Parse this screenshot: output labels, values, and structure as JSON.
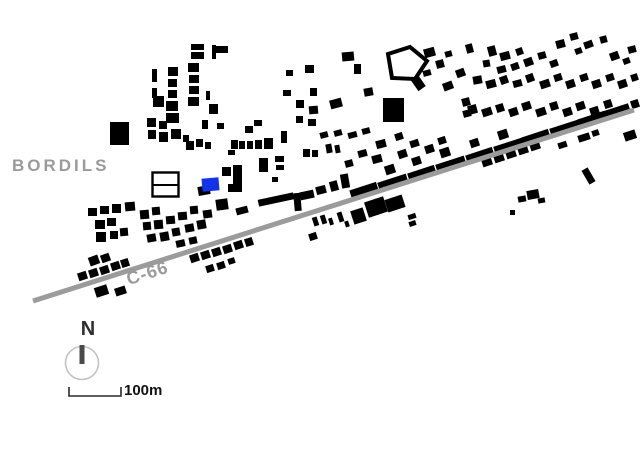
{
  "map": {
    "town_label": "BORDILS",
    "road_label": "C-66",
    "colors": {
      "building": "#000000",
      "highlight": "#1333e8",
      "road": "#9b9b9b",
      "label_gray": "#9a9a9a",
      "outline_stroke": "#000000",
      "background": "#ffffff"
    },
    "road": {
      "x1": 33,
      "y1": 301,
      "x2": 634,
      "y2": 110,
      "width": 5
    },
    "highlight_building": [
      202,
      178,
      17,
      13,
      -5
    ],
    "outline_rect_building": {
      "x": 152.5,
      "y": 172.5,
      "w": 26,
      "h": 24,
      "divider_y": 185,
      "stroke_width": 2.4
    },
    "pentagon_building": {
      "points": [
        [
          388,
          54
        ],
        [
          410,
          47
        ],
        [
          427,
          61
        ],
        [
          415,
          79
        ],
        [
          392,
          78
        ]
      ],
      "stroke_width": 4,
      "tail": [
        413,
        74,
        9,
        16,
        -35
      ]
    },
    "buildings": [
      [
        191,
        44,
        13,
        6,
        0
      ],
      [
        191,
        52,
        13,
        7,
        0
      ],
      [
        212,
        45,
        4,
        14,
        0
      ],
      [
        216,
        46,
        12,
        7,
        0
      ],
      [
        152,
        69,
        5,
        13,
        0
      ],
      [
        152,
        88,
        5,
        10,
        0
      ],
      [
        168,
        67,
        10,
        9,
        0
      ],
      [
        168,
        79,
        9,
        8,
        0
      ],
      [
        168,
        90,
        9,
        8,
        0
      ],
      [
        166,
        101,
        12,
        10,
        0
      ],
      [
        166,
        113,
        13,
        10,
        0
      ],
      [
        188,
        63,
        11,
        9,
        0
      ],
      [
        189,
        75,
        10,
        8,
        0
      ],
      [
        189,
        86,
        10,
        8,
        0
      ],
      [
        188,
        97,
        11,
        9,
        0
      ],
      [
        153,
        96,
        11,
        11,
        0
      ],
      [
        206,
        91,
        4,
        9,
        0
      ],
      [
        209,
        104,
        9,
        10,
        0
      ],
      [
        147,
        118,
        9,
        9,
        0
      ],
      [
        159,
        121,
        8,
        8,
        0
      ],
      [
        148,
        130,
        8,
        9,
        0
      ],
      [
        159,
        132,
        9,
        10,
        0
      ],
      [
        171,
        129,
        10,
        10,
        0
      ],
      [
        183,
        135,
        6,
        7,
        0
      ],
      [
        186,
        141,
        8,
        9,
        0
      ],
      [
        196,
        139,
        7,
        8,
        0
      ],
      [
        205,
        142,
        6,
        7,
        0
      ],
      [
        202,
        120,
        6,
        9,
        0
      ],
      [
        110,
        122,
        19,
        23,
        0
      ],
      [
        217,
        123,
        7,
        6,
        0
      ],
      [
        245,
        126,
        8,
        7,
        0
      ],
      [
        254,
        120,
        8,
        6,
        0
      ],
      [
        231,
        140,
        7,
        9,
        0
      ],
      [
        239,
        141,
        6,
        8,
        0
      ],
      [
        247,
        141,
        6,
        8,
        0
      ],
      [
        255,
        140,
        7,
        9,
        0
      ],
      [
        264,
        138,
        9,
        11,
        0
      ],
      [
        281,
        131,
        6,
        12,
        0
      ],
      [
        228,
        150,
        7,
        5,
        0
      ],
      [
        259,
        158,
        9,
        14,
        0
      ],
      [
        275,
        156,
        9,
        6,
        0
      ],
      [
        276,
        165,
        8,
        5,
        0
      ],
      [
        303,
        149,
        7,
        8,
        0
      ],
      [
        312,
        150,
        6,
        7,
        0
      ],
      [
        326,
        144,
        6,
        9,
        -10
      ],
      [
        335,
        145,
        5,
        8,
        -10
      ],
      [
        272,
        177,
        6,
        5,
        0
      ],
      [
        305,
        65,
        9,
        8,
        0
      ],
      [
        286,
        70,
        7,
        6,
        0
      ],
      [
        283,
        90,
        8,
        6,
        0
      ],
      [
        310,
        88,
        7,
        8,
        0
      ],
      [
        296,
        100,
        8,
        8,
        0
      ],
      [
        309,
        106,
        9,
        8,
        -5
      ],
      [
        296,
        116,
        7,
        7,
        0
      ],
      [
        308,
        119,
        8,
        7,
        0
      ],
      [
        330,
        99,
        12,
        9,
        -15
      ],
      [
        342,
        52,
        12,
        9,
        -5
      ],
      [
        354,
        64,
        7,
        10,
        0
      ],
      [
        364,
        88,
        9,
        8,
        -10
      ],
      [
        383,
        98,
        21,
        24,
        0
      ],
      [
        424,
        48,
        11,
        9,
        -15
      ],
      [
        436,
        60,
        8,
        8,
        -15
      ],
      [
        445,
        51,
        7,
        6,
        -15
      ],
      [
        423,
        70,
        8,
        6,
        -15
      ],
      [
        443,
        82,
        10,
        8,
        -20
      ],
      [
        456,
        69,
        9,
        8,
        -20
      ],
      [
        466,
        44,
        7,
        9,
        -15
      ],
      [
        556,
        40,
        9,
        8,
        -15
      ],
      [
        570,
        33,
        8,
        7,
        -15
      ],
      [
        584,
        41,
        9,
        7,
        -20
      ],
      [
        600,
        36,
        7,
        7,
        -15
      ],
      [
        575,
        48,
        7,
        6,
        -20
      ],
      [
        610,
        52,
        9,
        8,
        -20
      ],
      [
        628,
        46,
        8,
        7,
        -15
      ],
      [
        623,
        58,
        7,
        6,
        -20
      ],
      [
        488,
        46,
        8,
        10,
        -15
      ],
      [
        500,
        52,
        10,
        8,
        -15
      ],
      [
        516,
        48,
        7,
        7,
        -20
      ],
      [
        524,
        58,
        9,
        8,
        -20
      ],
      [
        538,
        52,
        8,
        7,
        -15
      ],
      [
        550,
        60,
        8,
        7,
        -20
      ],
      [
        483,
        60,
        7,
        7,
        -10
      ],
      [
        497,
        66,
        9,
        7,
        -15
      ],
      [
        511,
        63,
        8,
        7,
        -20
      ],
      [
        473,
        76,
        9,
        8,
        -10
      ],
      [
        486,
        80,
        10,
        8,
        -15
      ],
      [
        500,
        76,
        8,
        8,
        -20
      ],
      [
        513,
        80,
        9,
        7,
        -15
      ],
      [
        526,
        74,
        8,
        8,
        -20
      ],
      [
        540,
        80,
        10,
        8,
        -18
      ],
      [
        554,
        74,
        8,
        7,
        -18
      ],
      [
        566,
        80,
        9,
        8,
        -18
      ],
      [
        580,
        74,
        8,
        7,
        -18
      ],
      [
        592,
        80,
        9,
        8,
        -18
      ],
      [
        606,
        74,
        8,
        7,
        -18
      ],
      [
        618,
        80,
        9,
        8,
        -18
      ],
      [
        631,
        74,
        7,
        7,
        -18
      ],
      [
        468,
        105,
        9,
        9,
        -15
      ],
      [
        482,
        108,
        10,
        8,
        -18
      ],
      [
        496,
        104,
        8,
        8,
        -18
      ],
      [
        509,
        108,
        9,
        8,
        -18
      ],
      [
        522,
        102,
        9,
        8,
        -18
      ],
      [
        536,
        108,
        10,
        8,
        -18
      ],
      [
        550,
        102,
        8,
        8,
        -18
      ],
      [
        563,
        108,
        9,
        8,
        -18
      ],
      [
        576,
        102,
        9,
        8,
        -18
      ],
      [
        590,
        107,
        9,
        8,
        -18
      ],
      [
        604,
        100,
        8,
        8,
        -18
      ],
      [
        617,
        106,
        9,
        8,
        -18
      ],
      [
        631,
        100,
        8,
        8,
        -18
      ],
      [
        462,
        98,
        8,
        8,
        -15
      ],
      [
        463,
        110,
        8,
        7,
        -15
      ],
      [
        350,
        186,
        28,
        9,
        -18
      ],
      [
        378,
        178,
        30,
        10,
        -18
      ],
      [
        408,
        169,
        28,
        10,
        -18
      ],
      [
        436,
        160,
        30,
        10,
        -18
      ],
      [
        466,
        151,
        28,
        10,
        -18
      ],
      [
        494,
        142,
        30,
        10,
        -18
      ],
      [
        522,
        133,
        28,
        10,
        -18
      ],
      [
        550,
        124,
        30,
        10,
        -18
      ],
      [
        578,
        115,
        28,
        10,
        -18
      ],
      [
        604,
        107,
        26,
        9,
        -18
      ],
      [
        385,
        165,
        10,
        9,
        -18
      ],
      [
        412,
        157,
        9,
        8,
        -18
      ],
      [
        440,
        148,
        10,
        9,
        -18
      ],
      [
        470,
        139,
        9,
        8,
        -18
      ],
      [
        498,
        130,
        10,
        9,
        -18
      ],
      [
        320,
        132,
        8,
        6,
        -15
      ],
      [
        334,
        130,
        8,
        6,
        -15
      ],
      [
        348,
        132,
        9,
        6,
        -15
      ],
      [
        362,
        128,
        8,
        6,
        -15
      ],
      [
        376,
        140,
        10,
        8,
        -15
      ],
      [
        395,
        133,
        8,
        7,
        -18
      ],
      [
        410,
        140,
        9,
        7,
        -18
      ],
      [
        358,
        150,
        9,
        7,
        -15
      ],
      [
        372,
        155,
        10,
        8,
        -15
      ],
      [
        345,
        160,
        8,
        7,
        -15
      ],
      [
        398,
        150,
        9,
        8,
        -18
      ],
      [
        425,
        145,
        9,
        8,
        -18
      ],
      [
        438,
        137,
        8,
        7,
        -18
      ],
      [
        222,
        167,
        9,
        9,
        0
      ],
      [
        233,
        165,
        9,
        27,
        0
      ],
      [
        228,
        184,
        8,
        8,
        0
      ],
      [
        198,
        186,
        12,
        9,
        -10
      ],
      [
        216,
        199,
        12,
        11,
        -8
      ],
      [
        236,
        207,
        12,
        7,
        -15
      ],
      [
        258,
        196,
        36,
        7,
        -12
      ],
      [
        294,
        193,
        7,
        18,
        -5
      ],
      [
        300,
        191,
        14,
        8,
        -12
      ],
      [
        316,
        186,
        10,
        8,
        -15
      ],
      [
        330,
        181,
        8,
        10,
        -15
      ],
      [
        341,
        174,
        8,
        14,
        -10
      ],
      [
        88,
        208,
        9,
        8,
        0
      ],
      [
        100,
        206,
        9,
        8,
        0
      ],
      [
        112,
        204,
        9,
        9,
        0
      ],
      [
        125,
        202,
        10,
        9,
        -5
      ],
      [
        95,
        220,
        10,
        9,
        0
      ],
      [
        107,
        218,
        9,
        8,
        0
      ],
      [
        96,
        232,
        10,
        10,
        0
      ],
      [
        110,
        231,
        8,
        8,
        0
      ],
      [
        120,
        228,
        8,
        8,
        -5
      ],
      [
        140,
        210,
        9,
        9,
        -5
      ],
      [
        152,
        207,
        8,
        8,
        -5
      ],
      [
        143,
        222,
        8,
        8,
        -5
      ],
      [
        154,
        220,
        9,
        9,
        -5
      ],
      [
        166,
        216,
        9,
        8,
        -5
      ],
      [
        178,
        212,
        9,
        8,
        -5
      ],
      [
        147,
        234,
        9,
        8,
        -10
      ],
      [
        160,
        232,
        9,
        9,
        -10
      ],
      [
        172,
        228,
        8,
        8,
        -10
      ],
      [
        185,
        224,
        9,
        8,
        -10
      ],
      [
        197,
        220,
        9,
        9,
        -10
      ],
      [
        190,
        206,
        8,
        8,
        -5
      ],
      [
        203,
        210,
        9,
        8,
        -8
      ],
      [
        176,
        240,
        9,
        7,
        -12
      ],
      [
        189,
        237,
        8,
        7,
        -12
      ],
      [
        78,
        272,
        9,
        8,
        -18
      ],
      [
        89,
        269,
        9,
        8,
        -18
      ],
      [
        100,
        266,
        9,
        8,
        -18
      ],
      [
        111,
        262,
        9,
        8,
        -18
      ],
      [
        121,
        259,
        8,
        8,
        -18
      ],
      [
        89,
        256,
        10,
        9,
        -20
      ],
      [
        101,
        254,
        9,
        8,
        -20
      ],
      [
        95,
        286,
        13,
        10,
        -18
      ],
      [
        115,
        287,
        11,
        8,
        -18
      ],
      [
        190,
        254,
        9,
        8,
        -18
      ],
      [
        201,
        251,
        9,
        8,
        -18
      ],
      [
        212,
        248,
        9,
        8,
        -18
      ],
      [
        223,
        245,
        9,
        8,
        -18
      ],
      [
        234,
        241,
        9,
        8,
        -18
      ],
      [
        245,
        238,
        8,
        8,
        -18
      ],
      [
        206,
        265,
        8,
        7,
        -18
      ],
      [
        217,
        262,
        8,
        7,
        -18
      ],
      [
        228,
        258,
        7,
        6,
        -18
      ],
      [
        313,
        217,
        5,
        9,
        -18
      ],
      [
        321,
        215,
        5,
        9,
        -18
      ],
      [
        329,
        218,
        4,
        7,
        -18
      ],
      [
        338,
        212,
        5,
        10,
        -18
      ],
      [
        345,
        221,
        4,
        6,
        -18
      ],
      [
        309,
        233,
        8,
        7,
        -18
      ],
      [
        352,
        209,
        13,
        14,
        -18
      ],
      [
        366,
        199,
        20,
        16,
        -18
      ],
      [
        386,
        197,
        18,
        13,
        -18
      ],
      [
        408,
        214,
        8,
        5,
        -18
      ],
      [
        409,
        221,
        7,
        5,
        -18
      ],
      [
        482,
        158,
        10,
        8,
        -18
      ],
      [
        494,
        154,
        10,
        8,
        -18
      ],
      [
        506,
        150,
        10,
        8,
        -18
      ],
      [
        518,
        146,
        10,
        8,
        -18
      ],
      [
        530,
        142,
        10,
        8,
        -18
      ],
      [
        518,
        196,
        8,
        6,
        -10
      ],
      [
        527,
        190,
        12,
        9,
        -10
      ],
      [
        538,
        198,
        7,
        5,
        -10
      ],
      [
        510,
        210,
        5,
        5,
        0
      ],
      [
        585,
        168,
        7,
        16,
        -30
      ],
      [
        578,
        134,
        12,
        7,
        -18
      ],
      [
        592,
        130,
        7,
        6,
        -18
      ],
      [
        558,
        142,
        9,
        6,
        -18
      ],
      [
        624,
        131,
        12,
        9,
        -18
      ]
    ]
  },
  "compass": {
    "label": "N",
    "circle_color": "#c2c2c2",
    "needle_color": "#4a4a4a"
  },
  "scalebar": {
    "label": "100m"
  }
}
